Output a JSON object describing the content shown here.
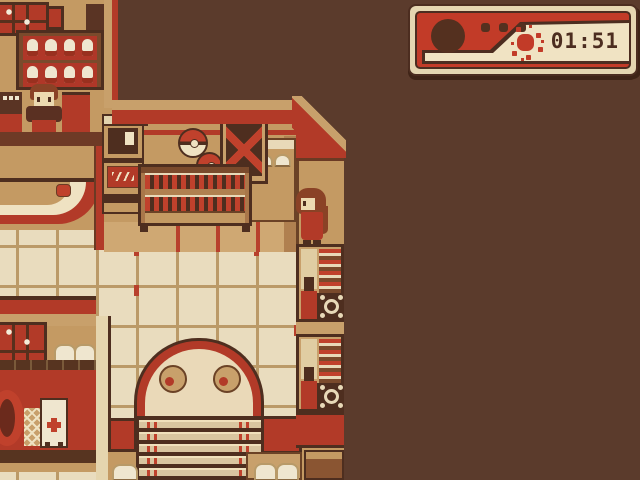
{
  "window": {
    "kind": "game-screenshot",
    "style": "top-down 2D RPG interior, sepia-red Game Boy palette",
    "width": 640,
    "height": 480
  },
  "hud": {
    "time": "01:51",
    "icons": [
      "power-circle-icon",
      "three-dots-icon",
      "sun-icon"
    ],
    "colors": {
      "body_red": "#c23b28",
      "panel_cream": "#f0e3c3",
      "outline_brown": "#4c2d20",
      "border_cream": "#e5d6b1",
      "text": "#4c2d20"
    }
  },
  "scene": {
    "areas": {
      "shop_counter": "top-left counter with clerk NPC and doll display shelf",
      "mart_floor": "central area with register machine, pokeballs, supply crate and potion shelf",
      "library_wall": "right column of bookshelves with a browsing NPC",
      "entrance": "bottom-center arched doorway with staircase",
      "side_room": "bottom-left room with window, lattice, poster and wreath",
      "void": "unexplored dark-brown area at top and right"
    },
    "npcs": [
      {
        "name": "clerk-npc",
        "pose": "facing-down",
        "hair": "#8a4226",
        "dress": "#b23a28"
      },
      {
        "name": "browsing-npc",
        "pose": "facing-left",
        "hair": "#8a4226",
        "dress": "#b23a28"
      }
    ],
    "objects": [
      "shop-window",
      "display-shelf",
      "counter",
      "round-rug",
      "register-machine",
      "pokeball",
      "pokeball",
      "supply-crate",
      "side-table",
      "potion-shelf",
      "bookshelf",
      "bookshelf",
      "gear-emblem",
      "door-arch",
      "staircase",
      "window",
      "wreath",
      "lattice-panel",
      "poster",
      "storage-box",
      "bench-buns"
    ],
    "palette": {
      "void": "#5b3b2c",
      "floor": "#e9dcbe",
      "grid": "#bb9a68",
      "wall_tan": "#c49a63",
      "red": "#b23a28",
      "outline": "#4e2e1f",
      "cream": "#efe2c2"
    }
  }
}
